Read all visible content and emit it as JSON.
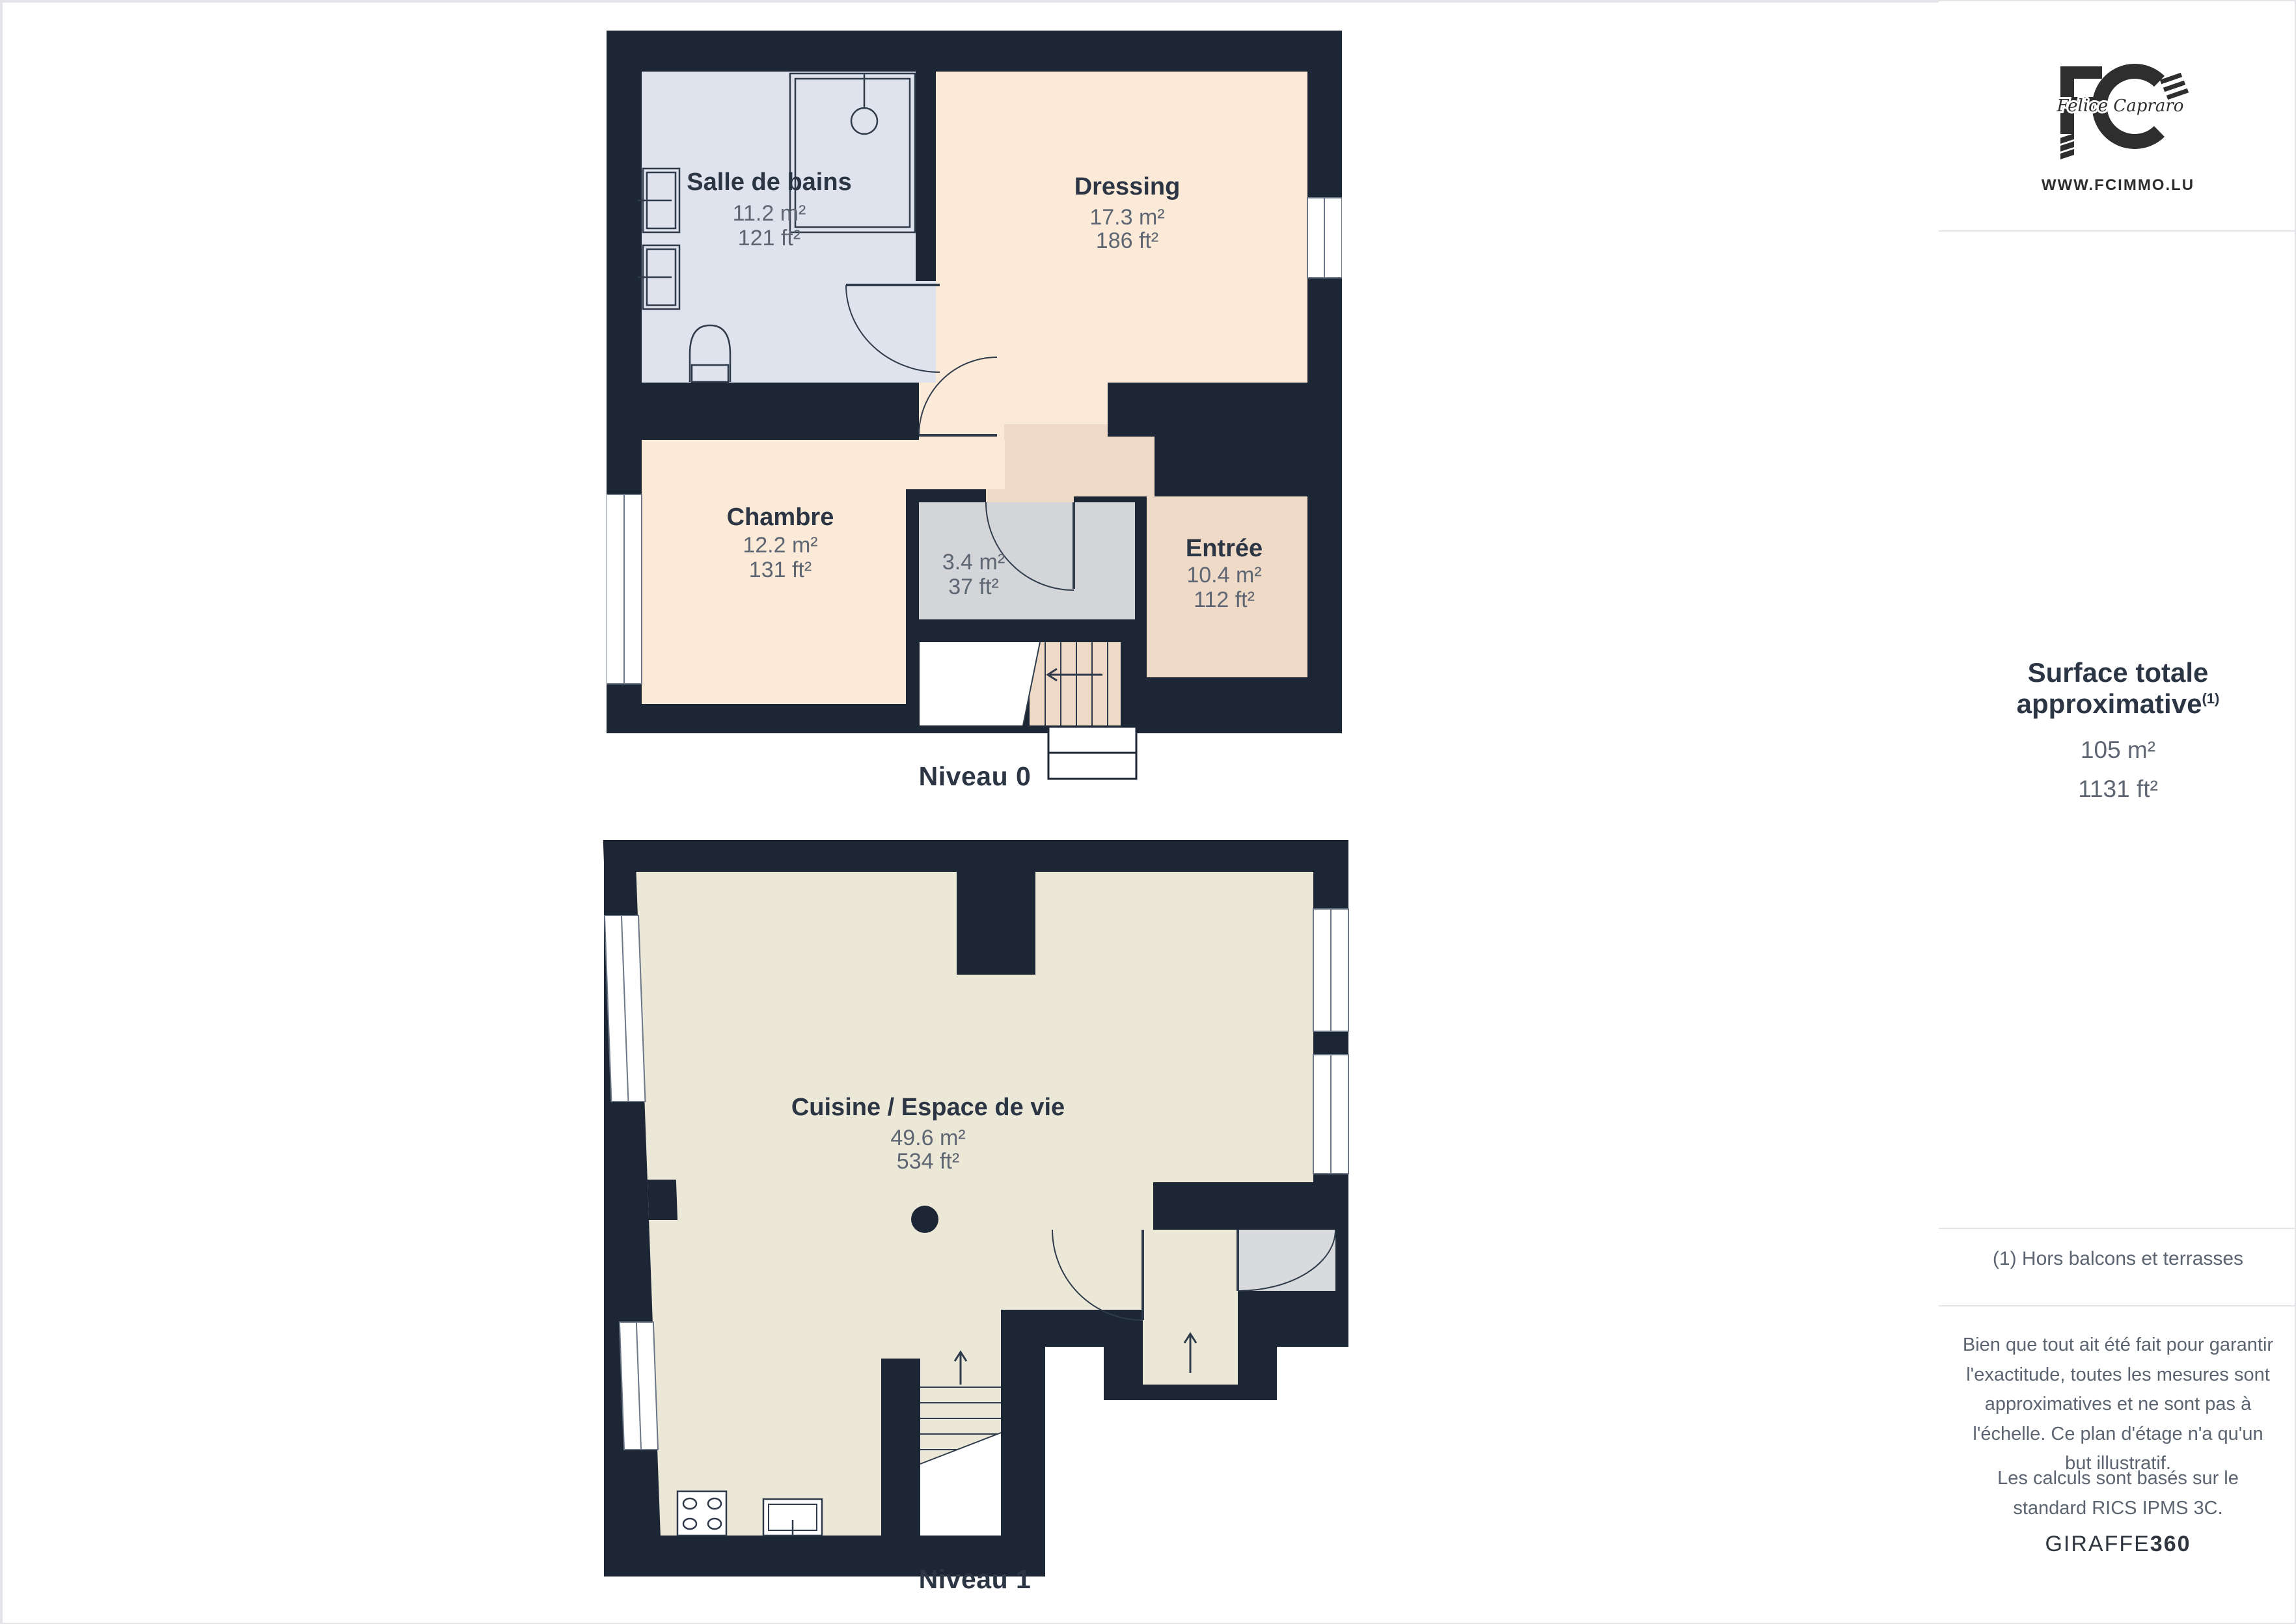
{
  "colors": {
    "wall": "#1c2634",
    "bath_floor": "#dfe3ee",
    "room_peach": "#fcead9",
    "room_tan": "#efdac8",
    "room_gray": "#d3d5d9",
    "kitchen_floor": "#ece8d8",
    "door_gray": "#d8dadd",
    "title_text": "#2b3544",
    "measure_text": "#5d6672"
  },
  "levels": [
    {
      "label": "Niveau 0",
      "rooms": [
        {
          "name": "Salle de bains",
          "area_m2": "11.2 m²",
          "area_ft2": "121 ft²"
        },
        {
          "name": "Dressing",
          "area_m2": "17.3 m²",
          "area_ft2": "186 ft²"
        },
        {
          "name": "Chambre",
          "area_m2": "12.2 m²",
          "area_ft2": "131 ft²"
        },
        {
          "name": "",
          "area_m2": "3.4 m²",
          "area_ft2": "37 ft²"
        },
        {
          "name": "Entrée",
          "area_m2": "10.4 m²",
          "area_ft2": "112 ft²"
        }
      ]
    },
    {
      "label": "Niveau 1",
      "rooms": [
        {
          "name": "Cuisine / Espace de vie",
          "area_m2": "49.6 m²",
          "area_ft2": "534 ft²"
        }
      ]
    }
  ],
  "sidebar": {
    "logo": {
      "script": "Felice Capraro",
      "website": "WWW.FCIMMO.LU"
    },
    "surface": {
      "title": "Surface totale approximative",
      "footnote_marker": "(1)",
      "value_m2": "105 m²",
      "value_ft2": "1131 ft²"
    },
    "footnote": "(1) Hors balcons et terrasses",
    "disclaimer_1": "Bien que tout ait été fait pour garantir l'exactitude, toutes les mesures sont approximatives et ne sont pas à l'échelle. Ce plan d'étage n'a qu'un but illustratif.",
    "disclaimer_2": "Les calculs sont basés sur le standard RICS IPMS 3C.",
    "brand": {
      "name": "GIRAFFE",
      "suffix": "360"
    }
  }
}
